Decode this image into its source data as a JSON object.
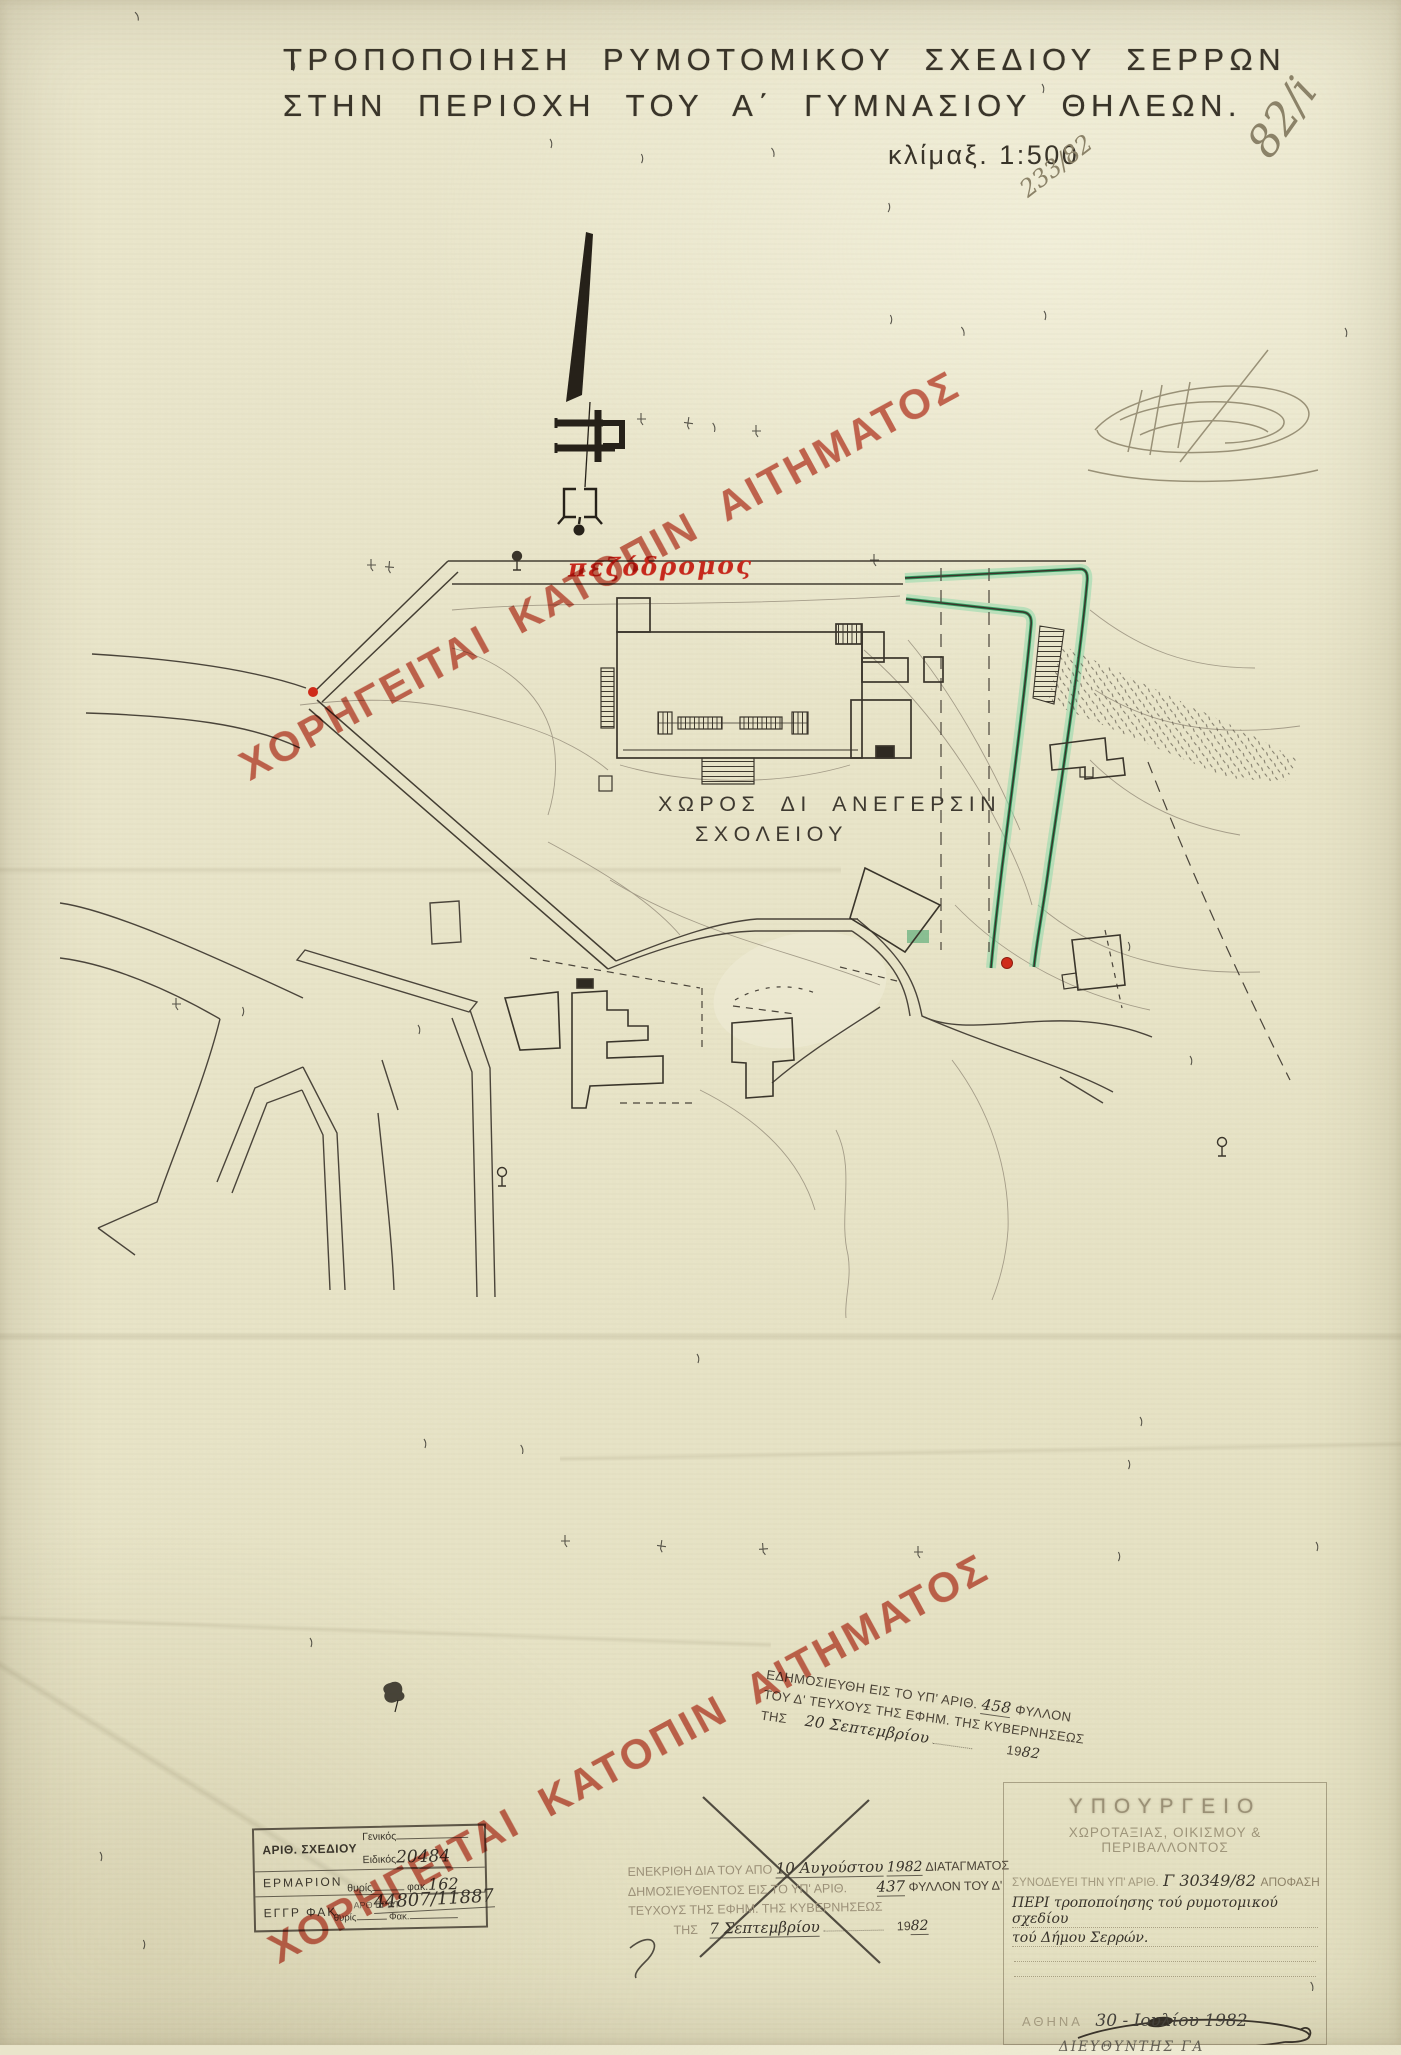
{
  "page": {
    "title_line1": "ΤΡΟΠΟΠΟΙΗΣΗ ΡΥΜΟΤΟΜΙΚΟΥ ΣΧΕΔΙΟΥ ΣΕΡΡΩΝ",
    "title_line2": "ΣΤΗΝ ΠΕΡΙΟΧΗ ΤΟΥ Α΄ ΓΥΜΝΑΣΙΟΥ ΘΗΛΕΩΝ.",
    "scale_label": "κλίμαξ. 1:500"
  },
  "pencil_notes": {
    "protocol_small": "233/82",
    "protocol_large": "82/i"
  },
  "watermark": {
    "text": "ΧΟΡΗΓΕΙΤΑΙ ΚΑΤΟΠΙΝ ΑΙΤΗΜΑΤΟΣ"
  },
  "map": {
    "pedestrian_street_label": "πεζόδρομος",
    "school_site_label_line1": "ΧΩΡΟΣ ΔΙ ΑΝΕΓΕΡΣΙΝ",
    "school_site_label_line2": "ΣΧΟΛΕΙΟΥ"
  },
  "publication_stamp": {
    "line1_prefix": "ΕΔΗΜΟΣΙΕΥΘΗ ΕΙΣ ΤΟ ΥΠ' ΑΡΙΘ.",
    "line1_number": "458",
    "line1_suffix": "ΦΥΛΛΟΝ",
    "line2": "ΤΟΥ Δ' ΤΕΥΧΟΥΣ ΤΗΣ ΕΦΗΜ. ΤΗΣ ΚΥΒΕΡΝΗΣΕΩΣ",
    "line3_prefix": "ΤΗΣ",
    "line3_date": "20 Σεπτεμβρίου",
    "line3_year_prefix": "19",
    "line3_year": "82"
  },
  "approval_stamp": {
    "line1_prefix": "ΕΝΕΚΡΙΘΗ ΔΙΑ ΤΟΥ ΑΠΟ",
    "line1_date": "10 Αυγούστου",
    "line1_year": "1982",
    "line1_suffix": "ΔΙΑΤΑΓΜΑΤΟΣ",
    "line2_prefix": "ΔΗΜΟΣΙΕΥΘΕΝΤΟΣ ΕΙΣ ΤΟ ΥΠ' ΑΡΙΘ.",
    "line2_number": "437",
    "line2_suffix": "ΦΥΛΛΟΝ ΤΟΥ Δ'",
    "line3": "ΤΕΥΧΟΥΣ ΤΗΣ ΕΦΗΜ. ΤΗΣ ΚΥΒΕΡΝΗΣΕΩΣ",
    "line4_prefix": "ΤΗΣ",
    "line4_date": "7 Σεπτεμβρίου",
    "line4_year_prefix": "19",
    "line4_year": "82"
  },
  "drawing_number_stamp": {
    "row1_label": "ΑΡΙΘ. ΣΧΕΔΙΟΥ",
    "row1_general_label": "Γενικός",
    "row1_special_label": "Ειδικός",
    "row1_special_value": "20484",
    "row2_label": "ΕΡΜΑΡΙΟΝ",
    "row2_thyris_label": "θυρίς",
    "row2_fak_label": "φακ.",
    "row2_fak_value": "162",
    "row3_label": "ΕΓΓΡ ΦΑΚ.",
    "row3_proto_label": "ΑΡΘ ΠΡΩΤ",
    "row3_proto_value": "44807/11887",
    "row4_thyris_label": "θυρίς",
    "row4_fak_label": "Φακ."
  },
  "ministry_stamp": {
    "header_line1": "ΥΠΟΥΡΓΕΙΟ",
    "header_line2": "ΧΩΡΟΤΑΞΙΑΣ, ΟΙΚΙΣΜΟΥ & ΠΕΡΙΒΑΛΛΟΝΤΟΣ",
    "ref_prefix": "ΣΥΝΟΔΕΥΕΙ ΤΗΝ ΥΠ' ΑΡΙΘ.",
    "ref_number": "Γ 30349/82",
    "ref_suffix": "ΑΠΟΦΑΣΗ",
    "subject_line1": "ΠΕΡΙ τροποποίησης τού ρυμοτομικού σχεδίου",
    "subject_line2": "τού Δήμου Σερρών.",
    "city_label": "ΑΘΗΝΑ",
    "date_value": "30 - Ιουλίου 1982",
    "signer_line": "ΔΙΕΥΘΥΝΤΗΣ  ΓΑ"
  },
  "colors": {
    "paper": "#e8e4c8",
    "ink": "#3a352b",
    "stamp_red": "#c24231",
    "label_red": "#c6281c",
    "highlight_green": "#2c9a5e",
    "pencil": "#8b8268"
  }
}
